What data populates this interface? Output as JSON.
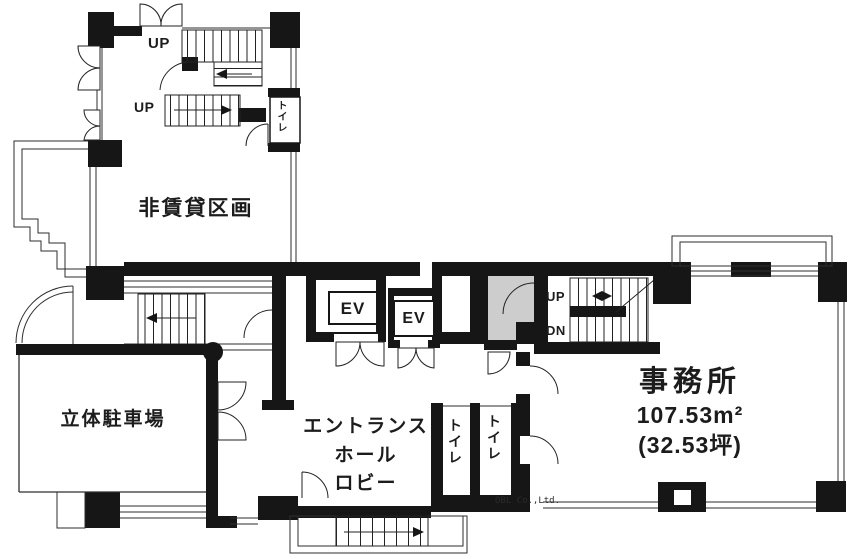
{
  "plan_title": "1F floor plan",
  "colors": {
    "walls": "#161616",
    "thin_lines": "#2e2e2e",
    "vestibule_gray": "#cdcdcd",
    "background": "#ffffff"
  },
  "rooms": {
    "non_rental": {
      "label": "非賃貸区画"
    },
    "parking": {
      "label": "立体駐車場"
    },
    "entrance": {
      "line1": "エントランス",
      "line2": "ホール",
      "line3": "ロビー"
    },
    "office": {
      "name": "事務所",
      "area_sqm": "107.53m²",
      "area_tsubo": "(32.53坪)"
    },
    "toilet": {
      "label": "トイレ"
    }
  },
  "marks": {
    "up": "UP",
    "down": "DN",
    "elevator": "EV"
  },
  "watermark": "OBL Co.,Ltd."
}
